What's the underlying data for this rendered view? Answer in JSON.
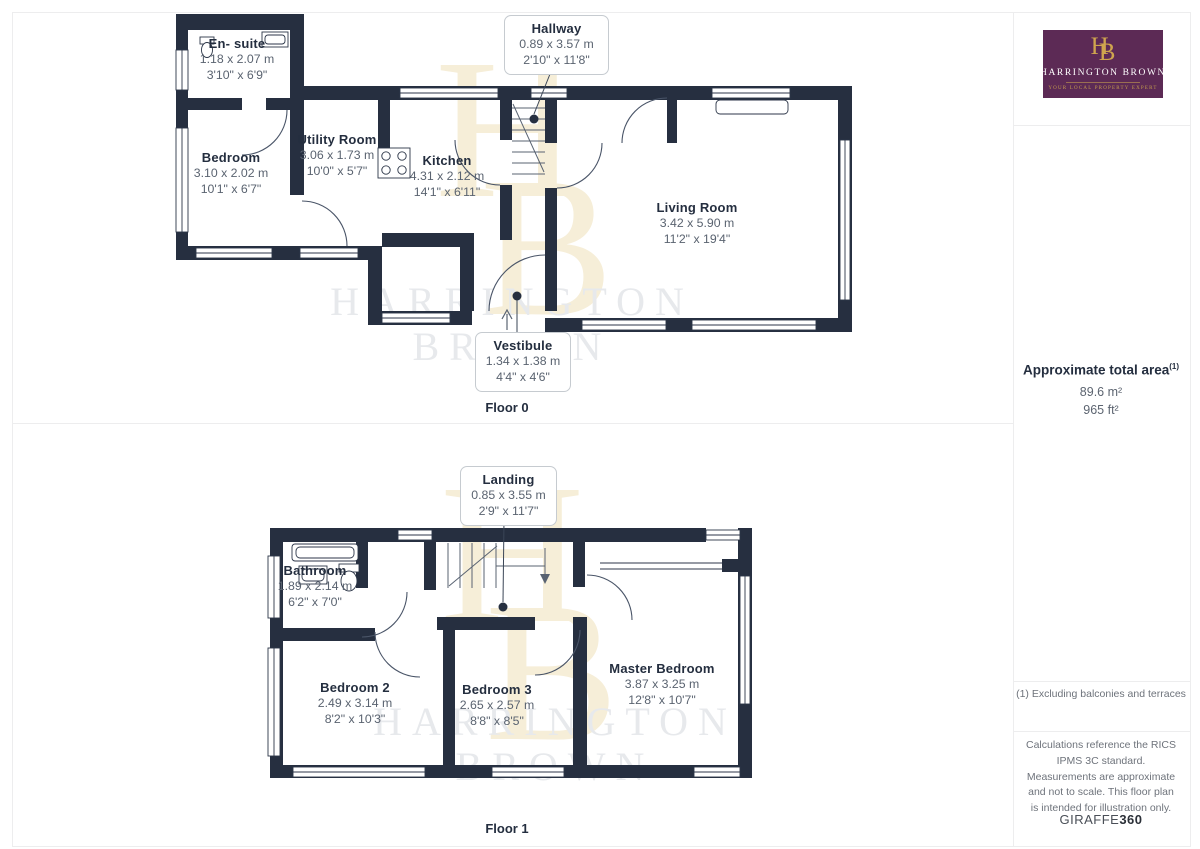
{
  "branding": {
    "monogram_h": "H",
    "monogram_b": "B",
    "agency_name": "HARRINGTON BROWN",
    "tagline": "YOUR LOCAL PROPERTY EXPERT",
    "watermark_line1": "HARRINGTON",
    "watermark_line2": "BROWN"
  },
  "sidebar": {
    "area_title": "Approximate total area",
    "area_superscript": "(1)",
    "area_metric": "89.6 m²",
    "area_imperial": "965 ft²",
    "footnote": "(1) Excluding balconies and terraces",
    "disclaimer": "Calculations reference the RICS IPMS 3C standard. Measurements are approximate and not to scale. This floor plan is intended for illustration only.",
    "vendor_name": "GIRAFFE",
    "vendor_suffix": "360"
  },
  "floor0": {
    "caption": "Floor 0",
    "rooms": {
      "ensuite": {
        "name": "En- suite",
        "metric": "1.18 x 2.07 m",
        "imperial": "3'10\" x 6'9\""
      },
      "bedroom": {
        "name": "Bedroom",
        "metric": "3.10 x 2.02 m",
        "imperial": "10'1\" x 6'7\""
      },
      "utility": {
        "name": "Utility Room",
        "metric": "3.06 x 1.73 m",
        "imperial": "10'0\" x 5'7\""
      },
      "kitchen": {
        "name": "Kitchen",
        "metric": "4.31 x 2.12 m",
        "imperial": "14'1\" x 6'11\""
      },
      "living": {
        "name": "Living Room",
        "metric": "3.42 x 5.90 m",
        "imperial": "11'2\" x 19'4\""
      }
    },
    "callouts": {
      "hallway": {
        "name": "Hallway",
        "metric": "0.89 x 3.57 m",
        "imperial": "2'10\" x 11'8\""
      },
      "vestibule": {
        "name": "Vestibule",
        "metric": "1.34 x 1.38 m",
        "imperial": "4'4\" x 4'6\""
      }
    }
  },
  "floor1": {
    "caption": "Floor 1",
    "rooms": {
      "bathroom": {
        "name": "Bathroom",
        "metric": "1.89 x 2.14 m",
        "imperial": "6'2\" x 7'0\""
      },
      "bedroom2": {
        "name": "Bedroom 2",
        "metric": "2.49 x 3.14 m",
        "imperial": "8'2\" x 10'3\""
      },
      "bedroom3": {
        "name": "Bedroom 3",
        "metric": "2.65 x 2.57 m",
        "imperial": "8'8\" x 8'5\""
      },
      "master": {
        "name": "Master Bedroom",
        "metric": "3.87 x 3.25 m",
        "imperial": "12'8\" x 10'7\""
      }
    },
    "callouts": {
      "landing": {
        "name": "Landing",
        "metric": "0.85 x 3.55 m",
        "imperial": "2'9\" x 11'7\""
      }
    }
  },
  "colors": {
    "wall": "#262f40",
    "logo_purple": "#5c2a55",
    "logo_gold": "#cfa54e",
    "dim_text": "#5a6370",
    "watermark_cream": "#f6eed8",
    "watermark_gray": "#e7e9ec"
  }
}
